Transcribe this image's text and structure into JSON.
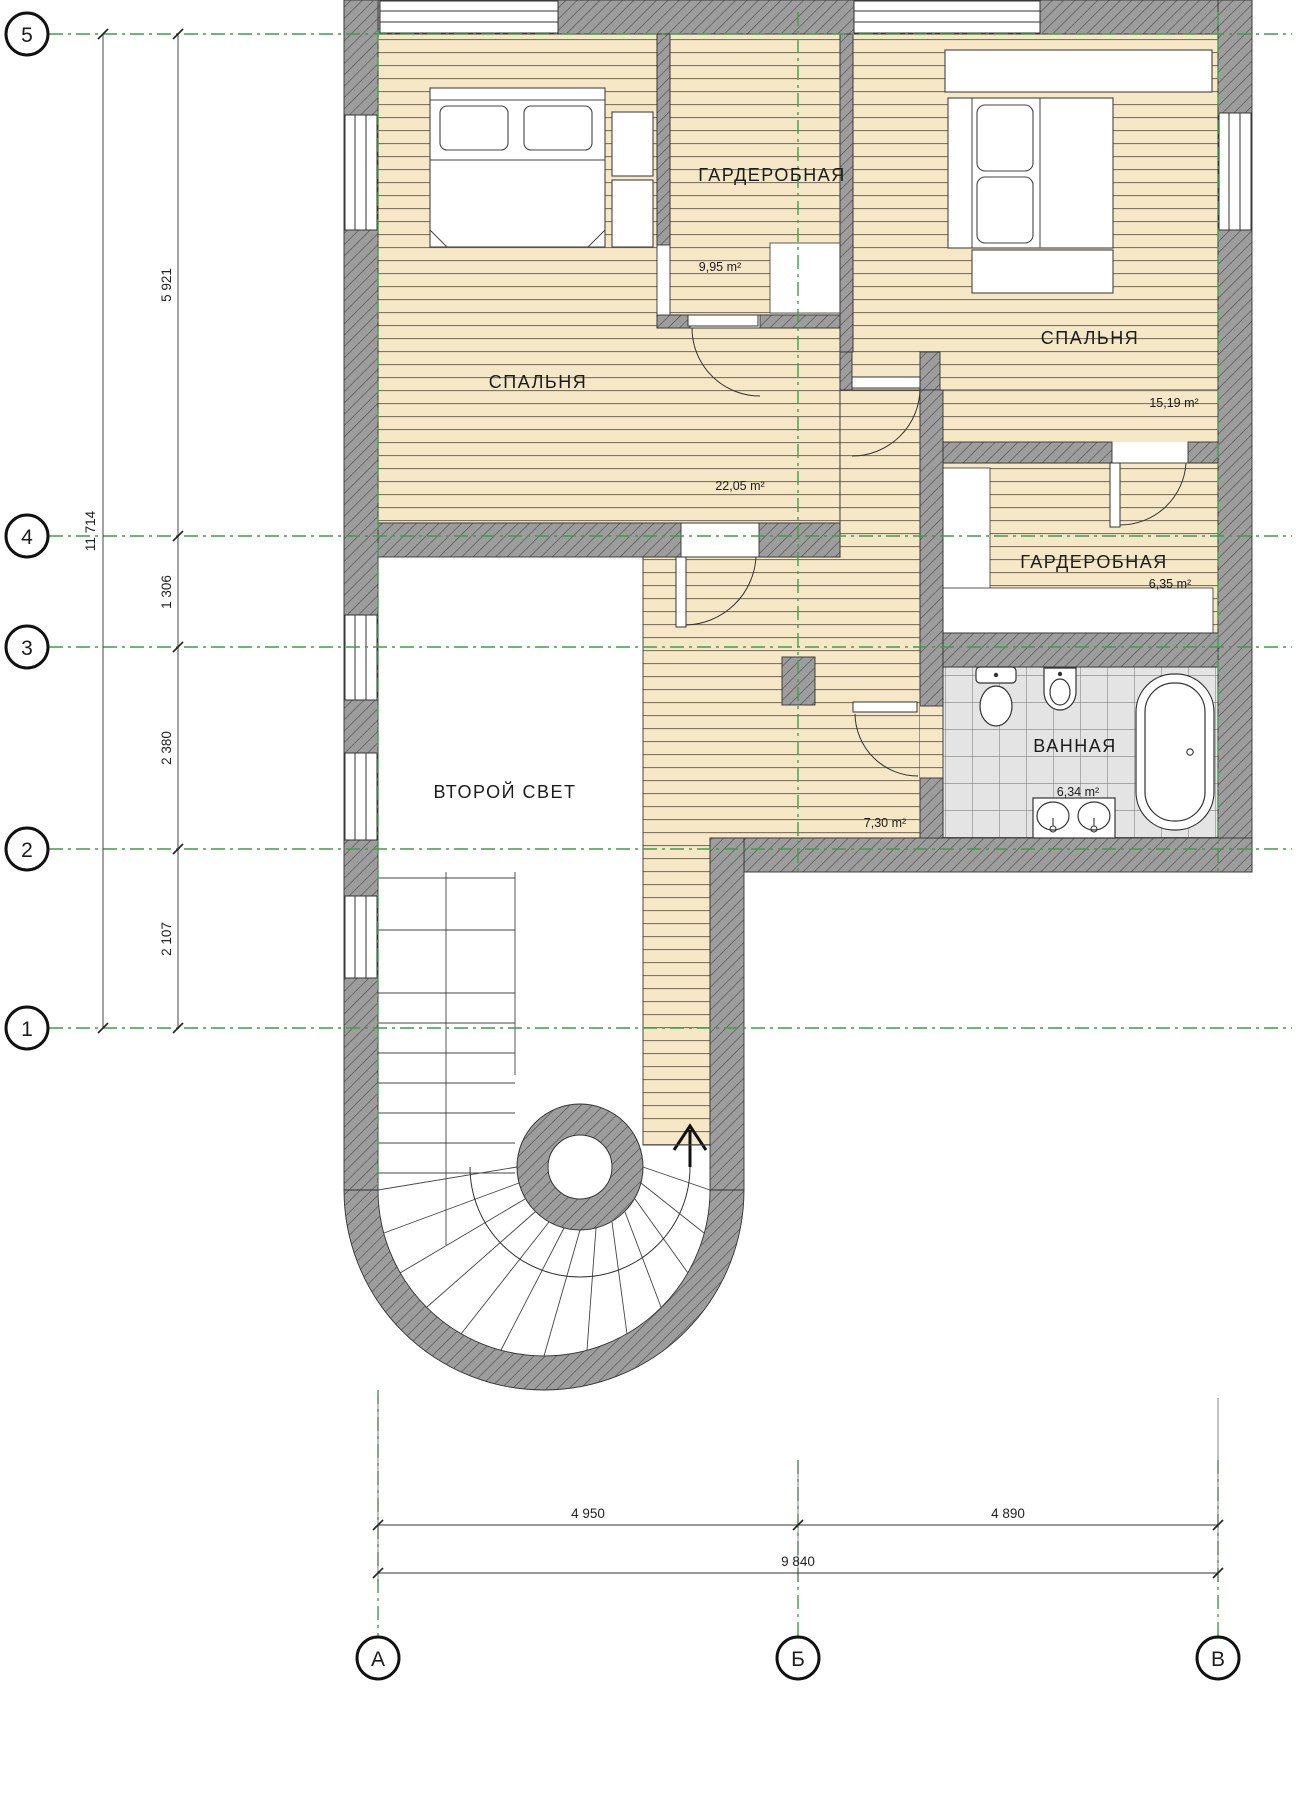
{
  "rooms": {
    "bedroom_left": {
      "label": "СПАЛЬНЯ",
      "area": "22,05 m²"
    },
    "wardrobe_top": {
      "label": "ГАРДЕРОБНАЯ",
      "area": "9,95 m²"
    },
    "bedroom_right": {
      "label": "СПАЛЬНЯ",
      "area": "15,19 m²"
    },
    "wardrobe_right": {
      "label": "ГАРДЕРОБНАЯ",
      "area": "6,35 m²"
    },
    "bathroom": {
      "label": "ВАННАЯ",
      "area": "6,34 m²"
    },
    "hall": {
      "area": "7,30 m²"
    },
    "void": {
      "label": "ВТОРОЙ СВЕТ"
    }
  },
  "axes": {
    "rows": [
      "5",
      "4",
      "3",
      "2",
      "1"
    ],
    "cols": [
      "А",
      "Б",
      "В"
    ]
  },
  "dimensions": {
    "vertical_total": "11 714",
    "vertical_segments": [
      "5 921",
      "1 306",
      "2 380",
      "2 107"
    ],
    "horizontal_segments": [
      "4 950",
      "4 890"
    ],
    "horizontal_total": "9 840"
  },
  "colors": {
    "wall_gray": "#9d9d9d",
    "wood_floor": "#f6e8c6",
    "tile_floor": "#e4e4e4",
    "axis_green": "#3f9e4c"
  }
}
